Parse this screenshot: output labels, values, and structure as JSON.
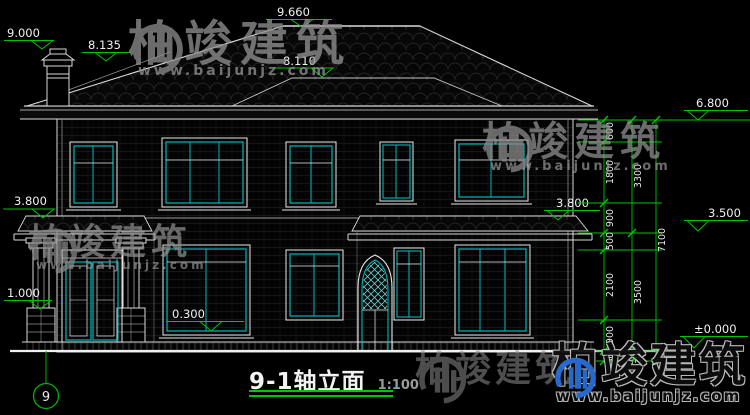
{
  "title_block": {
    "title": "9-1轴立面",
    "scale": "1:100"
  },
  "axis": {
    "bubble": "9"
  },
  "levels": {
    "ridge": "9.660",
    "chimney": "9.000",
    "left_roof": "8.135",
    "front_ridge": "8.110",
    "eave": "6.800",
    "porch_roof_left": "3.800",
    "canopy_right": "3.800",
    "right_level": "3.500",
    "pedestal": "1.000",
    "entry_floor": "0.300",
    "ground": "±0.000"
  },
  "dimensions": {
    "inner_chain": [
      "600",
      "1800",
      "900",
      "500",
      "2100",
      "900",
      "300"
    ],
    "middle_chain": [
      "3300",
      "3500",
      "300"
    ],
    "overall_chain": [
      "7100"
    ]
  },
  "watermark": {
    "brand": "柏竣建筑",
    "url": "www.baijunjz.com"
  },
  "colors": {
    "background": "#000000",
    "lines": "#e6e6e6",
    "glass_frame": "#00b7b7",
    "annotation": "#00c400",
    "watermark_gray": "#8f8f8f",
    "logo_blue": "#2a6fd6"
  }
}
